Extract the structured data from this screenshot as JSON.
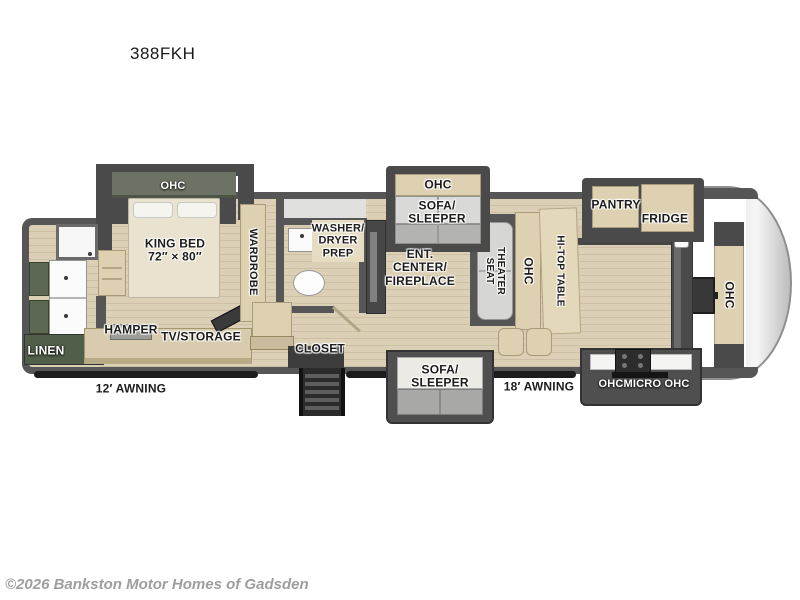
{
  "title": "388FKH",
  "copyright": "©2026 Bankston Motor Homes of Gadsden",
  "palette": {
    "wall": "#565656",
    "floor_wood": "#d8ccb3",
    "cabinet_beige": "#ddd1b2",
    "cabinet_olive": "#6d7364",
    "cabinet_green": "#5d6852",
    "slide_frame": "#4a4a4a",
    "label_text": "#1c1c1c"
  },
  "bedroom": {
    "ohc": "OHC",
    "king_bed": "KING BED\n72″ × 80″",
    "wardrobe": "WARDROBE",
    "hamper": "HAMPER",
    "tv_storage": "TV/STORAGE"
  },
  "rear_bath": {
    "linen": "LINEN"
  },
  "mid_bath": {
    "washer_dryer_prep": "WASHER/\nDRYER\nPREP",
    "closet": "CLOSET"
  },
  "living": {
    "ent_center": "ENT.\nCENTER/\nFIREPLACE",
    "sofa_ohc": "OHC",
    "sofa_top": "SOFA/\nSLEEPER",
    "sofa_bottom": "SOFA/\nSLEEPER",
    "theater_seat": "THEATER\nSEAT",
    "ohc": "OHC",
    "hitop_table": "HI-TOP TABLE"
  },
  "kitchen": {
    "pantry": "PANTRY",
    "fridge": "FRIDGE",
    "ohc_micro_row": "OHCMICRO OHC",
    "front_ohc": "OHC"
  },
  "exterior": {
    "awning_left": "12′ AWNING",
    "awning_right": "18′ AWNING"
  }
}
